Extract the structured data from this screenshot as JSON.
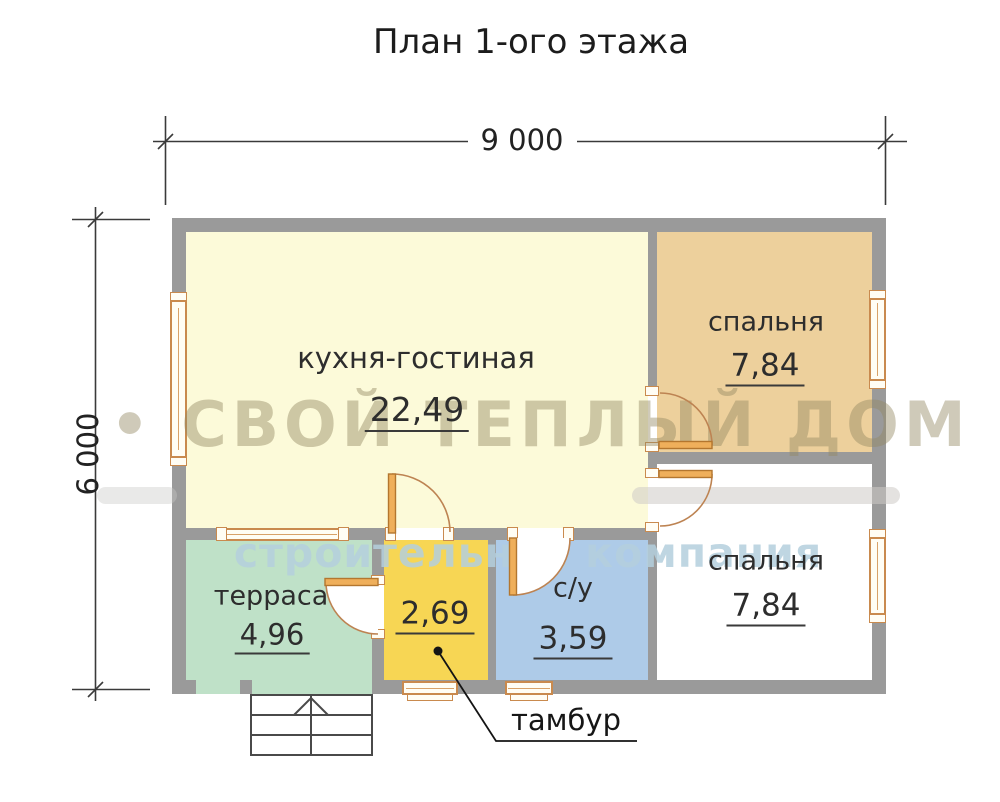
{
  "title": "План 1-ого этажа",
  "dimensions": {
    "width_label": "9 000",
    "height_label": "6 000"
  },
  "rooms": {
    "kitchen": {
      "name": "кухня-гостиная",
      "area": "22,49",
      "color": "#FCFAD9"
    },
    "bedroom_top": {
      "name": "спальня",
      "area": "7,84",
      "color": "#EDD09C"
    },
    "bedroom_bottom": {
      "name": "спальня",
      "area": "7,84",
      "color": "#FFFFFF"
    },
    "terrace": {
      "name": "терраса",
      "area": "4,96",
      "color": "#BFE1C8"
    },
    "tambour": {
      "name": "тамбур",
      "area": "2,69",
      "color": "#F7D654"
    },
    "bathroom": {
      "name": "с/у",
      "area": "3,59",
      "color": "#AECBE8"
    }
  },
  "callout": {
    "label": "тамбур"
  },
  "watermark": {
    "title": "• СВОЙ ТЕПЛЫЙ ДОМ •",
    "subtitle": "строительная компания"
  },
  "colors": {
    "wall": "#9A9A9A",
    "window_frame": "#C98A4E",
    "door_leaf": "#EFAF5B",
    "door_arc": "#BD8352",
    "dimension_line": "#3A3A3A",
    "stairs_line": "#4A4A4A"
  }
}
